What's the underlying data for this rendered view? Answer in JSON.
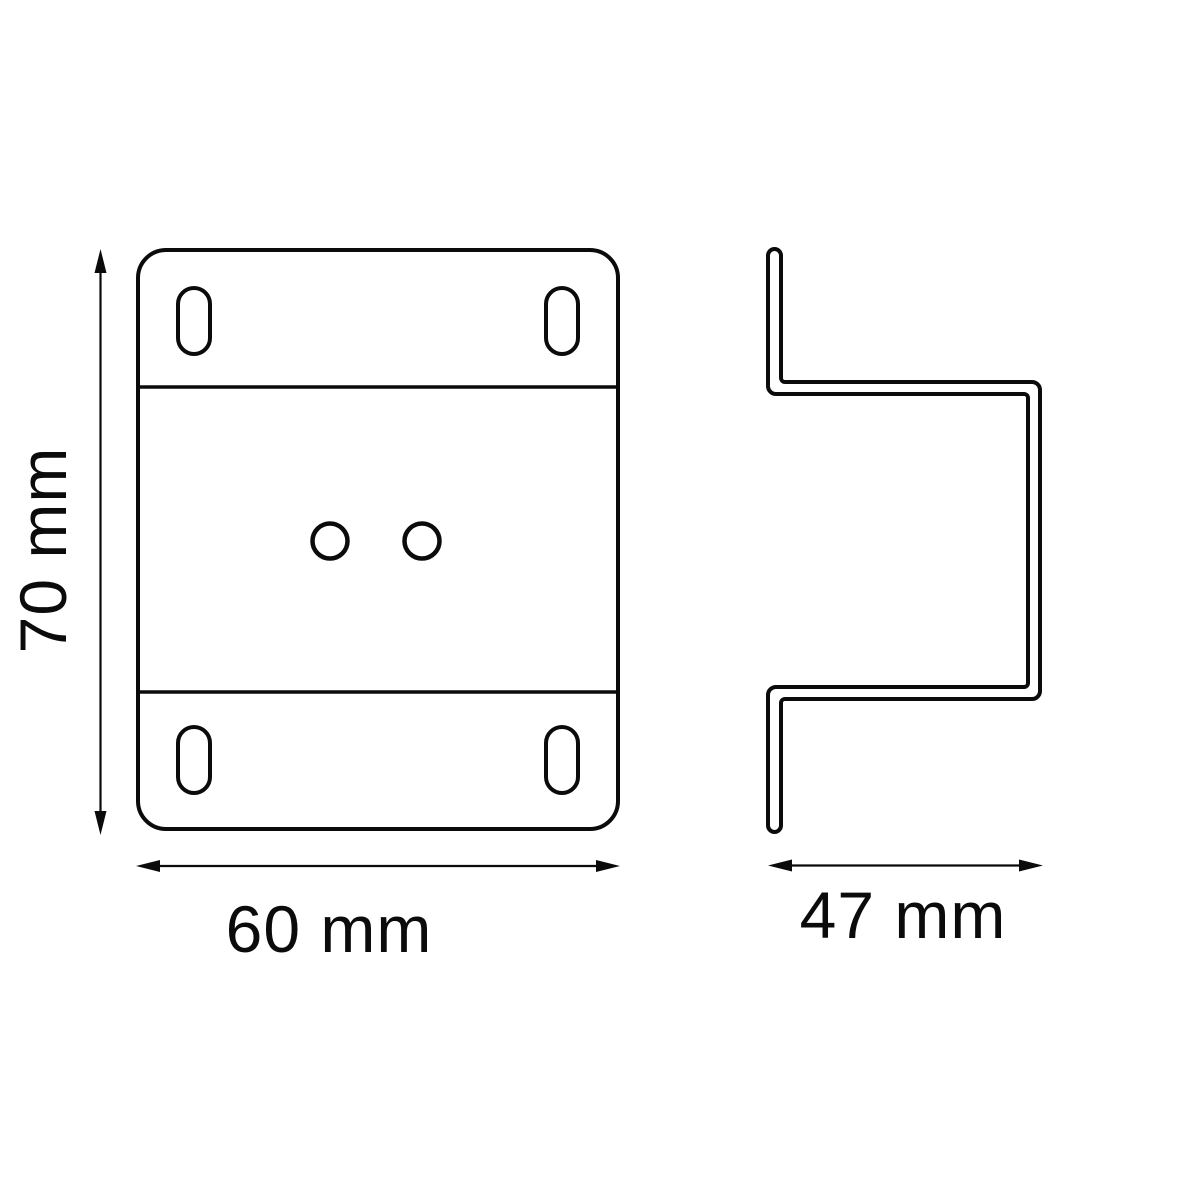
{
  "drawing": {
    "type": "two-view technical drawing",
    "subject": "mounting bracket",
    "line_color": "#0b0b0b",
    "background_color": "#ffffff"
  },
  "front_view": {
    "mounting_slots": 4,
    "center_holes": 2,
    "fold_lines": 2
  },
  "side_view": {
    "profile": "offset z-channel"
  },
  "dimensions": {
    "height": {
      "label": "70 mm",
      "value": 70,
      "unit": "mm",
      "orientation": "vertical",
      "applies_to": "front-view"
    },
    "width": {
      "label": "60 mm",
      "value": 60,
      "unit": "mm",
      "orientation": "horizontal",
      "applies_to": "front-view"
    },
    "depth": {
      "label": "47 mm",
      "value": 47,
      "unit": "mm",
      "orientation": "horizontal",
      "applies_to": "side-view"
    }
  }
}
